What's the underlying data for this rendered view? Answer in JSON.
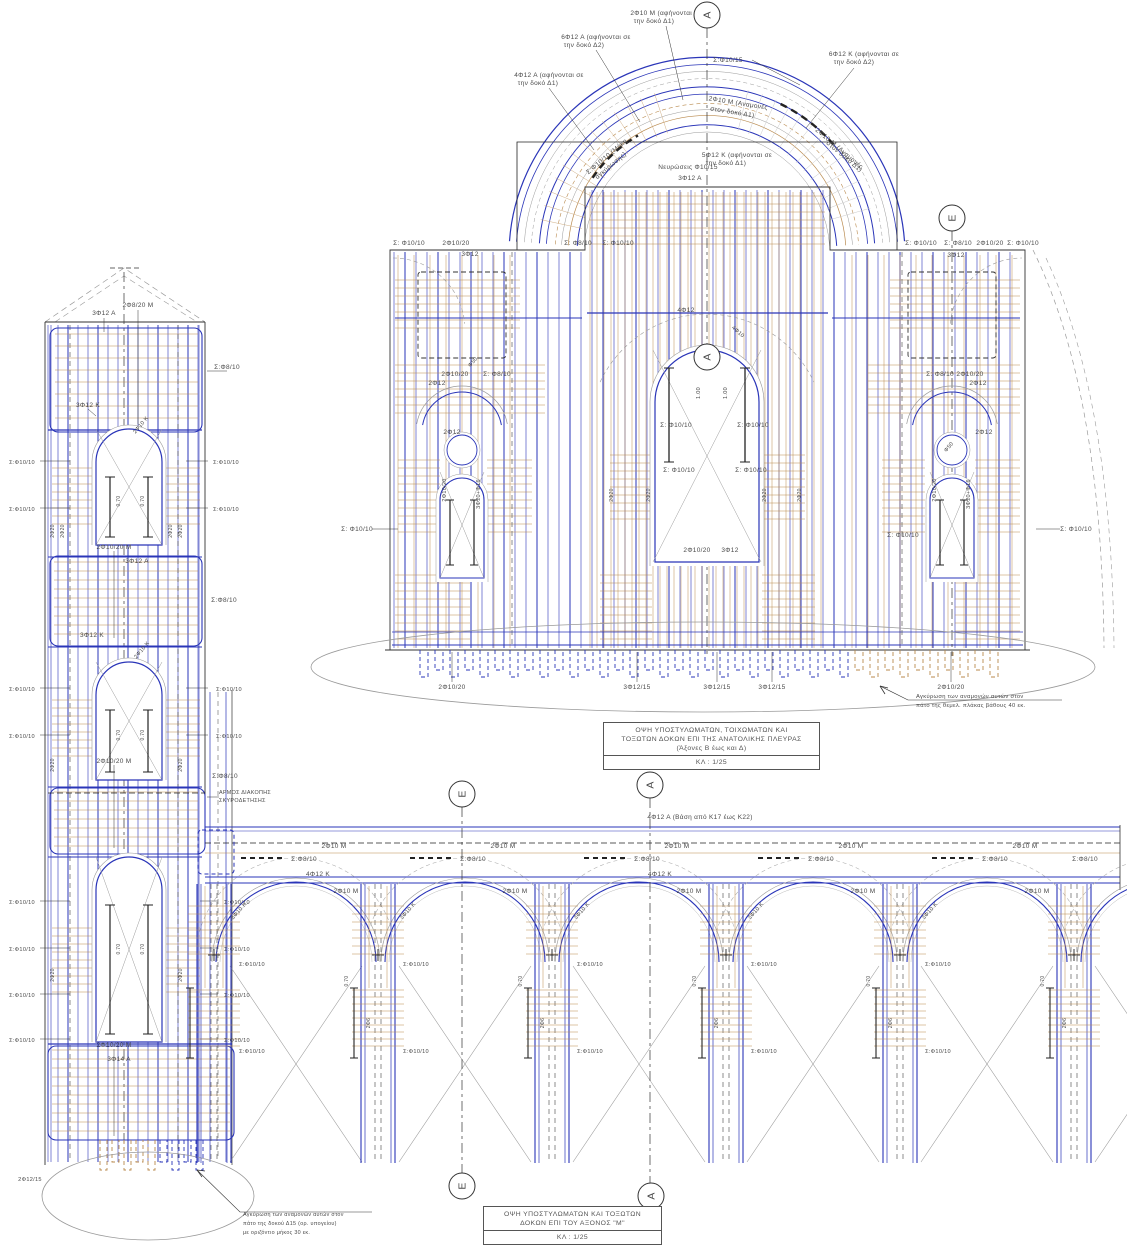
{
  "palette": {
    "blue": "#2a35b8",
    "navy": "#1a1a8c",
    "tan": "#b98a4e",
    "tan_light": "#cfae84",
    "gray": "#9a9a9a",
    "ink": "#4a4a4a",
    "ink_light": "#8d8d8d",
    "black": "#222222"
  },
  "east_elevation": {
    "title": {
      "lines": [
        "ΟΨΗ ΥΠΟΣΤΥΛΩΜΑΤΩΝ, ΤΟΙΧΩΜΑΤΩΝ ΚΑΙ",
        "ΤΟΞΩΤΩΝ ΔΟΚΩΝ ΕΠΙ ΤΗΣ ΑΝΑΤΟΛΙΚΗΣ ΠΛΕΥΡΑΣ",
        "(Άξονες Β έως και Δ)"
      ],
      "scale": "ΚΛ : 1/25"
    },
    "axes": [
      {
        "label": "Α",
        "x": 707,
        "y": 15
      },
      {
        "label": "Ε",
        "x": 952,
        "y": 218
      },
      {
        "label": "Α",
        "x": 707,
        "y": 357
      }
    ],
    "note": {
      "lines": [
        "Αγκύρωση των αναμονών αυτών στον",
        "πάτο της θεμελ. πλάκας βάθους 40 εκ."
      ]
    },
    "labels": [
      {
        "t": "6Φ12 Α (αφήνονται σε",
        "x": 596,
        "y": 39
      },
      {
        "t": "την δοκό Δ2)",
        "x": 584,
        "y": 47
      },
      {
        "t": "2Φ10 Μ (αφήνονται σε",
        "x": 666,
        "y": 15
      },
      {
        "t": "την δοκό Δ1)",
        "x": 654,
        "y": 23
      },
      {
        "t": "6Φ12 Κ (αφήνονται σε",
        "x": 864,
        "y": 56
      },
      {
        "t": "την δοκό Δ2)",
        "x": 854,
        "y": 64
      },
      {
        "t": "4Φ12 Α (αφήνονται σε",
        "x": 549,
        "y": 77
      },
      {
        "t": "την δοκό Δ1)",
        "x": 538,
        "y": 85
      },
      {
        "t": "Σ:Φ10/15",
        "x": 728,
        "y": 62
      },
      {
        "t": "2Φ10 Μ (Αναμονές",
        "x": 738,
        "y": 105,
        "r": 9
      },
      {
        "t": "στον δοκό Δ1)",
        "x": 732,
        "y": 114,
        "r": 9
      },
      {
        "t": "Σ:Φ10/10 (Μήκη",
        "x": 608,
        "y": 158,
        "r": -40
      },
      {
        "t": "αγκύρωσης)",
        "x": 612,
        "y": 167,
        "r": -40
      },
      {
        "t": "2Φ10 Μ (Αναμονές",
        "x": 838,
        "y": 150,
        "r": 40
      },
      {
        "t": "στον δοκό Δ1)",
        "x": 843,
        "y": 158,
        "r": 40
      },
      {
        "t": "Νευρώσεις Φ10/15",
        "x": 688,
        "y": 169
      },
      {
        "t": "3Φ12 Α",
        "x": 690,
        "y": 180
      },
      {
        "t": "5Φ12 Κ (αφήνονται σε",
        "x": 737,
        "y": 157
      },
      {
        "t": "την δοκό Δ1)",
        "x": 726,
        "y": 165
      },
      {
        "t": "Σ: Φ10/10",
        "x": 409,
        "y": 245
      },
      {
        "t": "2Φ10/20",
        "x": 456,
        "y": 245
      },
      {
        "t": "3Φ12",
        "x": 470,
        "y": 256
      },
      {
        "t": "Σ: Φ8/10",
        "x": 578,
        "y": 245
      },
      {
        "t": "Σ: Φ10/10",
        "x": 618,
        "y": 245
      },
      {
        "t": "Σ: Φ10/10",
        "x": 921,
        "y": 245
      },
      {
        "t": "Σ: Φ8/10",
        "x": 958,
        "y": 245
      },
      {
        "t": "2Φ10/20",
        "x": 990,
        "y": 245
      },
      {
        "t": "Σ: Φ10/10",
        "x": 1023,
        "y": 245
      },
      {
        "t": "3Φ12",
        "x": 956,
        "y": 257
      },
      {
        "t": "Σ: Φ10/10",
        "x": 357,
        "y": 531
      },
      {
        "t": "Σ: Φ10/10",
        "x": 1076,
        "y": 531
      },
      {
        "t": "2Φ10/20",
        "x": 455,
        "y": 376
      },
      {
        "t": "Σ: Φ8/10",
        "x": 497,
        "y": 376
      },
      {
        "t": "2Φ12",
        "x": 437,
        "y": 385
      },
      {
        "t": "Φ50",
        "x": 474,
        "y": 363,
        "r": -50,
        "s": 5.5
      },
      {
        "t": "2Φ12",
        "x": 452,
        "y": 434
      },
      {
        "t": "2Φ10/20",
        "x": 446,
        "y": 490,
        "r": -90,
        "s": 5.5
      },
      {
        "t": "3Φ20+Φ16",
        "x": 480,
        "y": 494,
        "r": -90,
        "s": 5.5
      },
      {
        "t": "Σ: Φ8/10",
        "x": 940,
        "y": 376
      },
      {
        "t": "2Φ10/20",
        "x": 970,
        "y": 376
      },
      {
        "t": "2Φ12",
        "x": 978,
        "y": 385
      },
      {
        "t": "2Φ12",
        "x": 984,
        "y": 434
      },
      {
        "t": "Φ50",
        "x": 950,
        "y": 448,
        "r": -50,
        "s": 5.5
      },
      {
        "t": "2Φ10/20",
        "x": 936,
        "y": 490,
        "r": -90,
        "s": 5.5
      },
      {
        "t": "3Φ20+Φ16",
        "x": 970,
        "y": 494,
        "r": -90,
        "s": 5.5
      },
      {
        "t": "Σ: Φ10/10",
        "x": 903,
        "y": 537
      },
      {
        "t": "4Φ12",
        "x": 686,
        "y": 312
      },
      {
        "t": "4Φ10",
        "x": 737,
        "y": 333,
        "r": 42,
        "s": 5.5
      },
      {
        "t": "Σ: Φ10/10",
        "x": 676,
        "y": 427
      },
      {
        "t": "Σ: Φ10/10",
        "x": 753,
        "y": 427
      },
      {
        "t": "Σ: Φ10/10",
        "x": 679,
        "y": 472
      },
      {
        "t": "Σ: Φ10/10",
        "x": 751,
        "y": 472
      },
      {
        "t": "1.00",
        "x": 700,
        "y": 393,
        "r": -90,
        "s": 5.5,
        "c": "g"
      },
      {
        "t": "1.00",
        "x": 727,
        "y": 393,
        "r": -90,
        "s": 5.5,
        "c": "g"
      },
      {
        "t": "2Φ20",
        "x": 613,
        "y": 495,
        "r": -90,
        "s": 5,
        "c": "g"
      },
      {
        "t": "2Φ20",
        "x": 650,
        "y": 495,
        "r": -90,
        "s": 5,
        "c": "g"
      },
      {
        "t": "2Φ20",
        "x": 766,
        "y": 495,
        "r": -90,
        "s": 5,
        "c": "g"
      },
      {
        "t": "2Φ20",
        "x": 801,
        "y": 495,
        "r": -90,
        "s": 5,
        "c": "g"
      },
      {
        "t": "2Φ10/20",
        "x": 697,
        "y": 552
      },
      {
        "t": "3Φ12",
        "x": 730,
        "y": 552
      },
      {
        "t": "2Φ10/20",
        "x": 452,
        "y": 689
      },
      {
        "t": "3Φ12/15",
        "x": 637,
        "y": 689
      },
      {
        "t": "3Φ12/15",
        "x": 717,
        "y": 689
      },
      {
        "t": "3Φ12/15",
        "x": 772,
        "y": 689
      },
      {
        "t": "2Φ10/20",
        "x": 951,
        "y": 689
      },
      {
        "t": "Αγκύρωση των αναμονών αυτών στον",
        "x": 916,
        "y": 698,
        "a": "s",
        "s": 5.8
      },
      {
        "t": "πάτο της θεμελ. πλάκας βάθους 40 εκ.",
        "x": 916,
        "y": 707,
        "a": "s",
        "s": 5.8
      }
    ]
  },
  "tower": {
    "note": {
      "lines": [
        "Αγκύρωση των αναμονών αυτών στον",
        "πάτο της δοκού Δ15 (ορ. υπογείου)",
        "με οριζόντιο μήκος 30 εκ."
      ]
    },
    "labels": [
      {
        "t": "3Φ12 Α",
        "x": 104,
        "y": 315
      },
      {
        "t": "2Φ8/20 Μ",
        "x": 138,
        "y": 307
      },
      {
        "t": "Σ:Φ8/10",
        "x": 227,
        "y": 369
      },
      {
        "t": "3Φ12 Κ",
        "x": 88,
        "y": 407
      },
      {
        "t": "2Φ10 Κ",
        "x": 142,
        "y": 426,
        "r": -50,
        "s": 5.5
      },
      {
        "t": "Σ:Φ10/10",
        "x": 22,
        "y": 464,
        "s": 5.6
      },
      {
        "t": "Σ:Φ10/10",
        "x": 22,
        "y": 511,
        "s": 5.6
      },
      {
        "t": "Σ:Φ10/10",
        "x": 226,
        "y": 464,
        "s": 5.6
      },
      {
        "t": "Σ:Φ10/10",
        "x": 226,
        "y": 511,
        "s": 5.6
      },
      {
        "t": "2Φ10/20 Μ",
        "x": 114,
        "y": 549
      },
      {
        "t": "3Φ12 Α",
        "x": 137,
        "y": 563
      },
      {
        "t": "Σ:Φ8/10",
        "x": 224,
        "y": 602
      },
      {
        "t": "3Φ12 Κ",
        "x": 92,
        "y": 637
      },
      {
        "t": "2Φ10 Κ",
        "x": 143,
        "y": 651,
        "r": -50,
        "s": 5.5
      },
      {
        "t": "Σ:Φ10/10",
        "x": 22,
        "y": 691,
        "s": 5.6
      },
      {
        "t": "Σ:Φ10/10",
        "x": 22,
        "y": 738,
        "s": 5.6
      },
      {
        "t": "Σ:Φ10/10",
        "x": 229,
        "y": 691,
        "s": 5.6
      },
      {
        "t": "Σ:Φ10/10",
        "x": 229,
        "y": 738,
        "s": 5.6
      },
      {
        "t": "2Φ10/20 Μ",
        "x": 114,
        "y": 763
      },
      {
        "t": "Σ:Φ8/10",
        "x": 225,
        "y": 778
      },
      {
        "t": "ΑΡΜΟΣ ΔΙΑΚΟΠΗΣ",
        "x": 219,
        "y": 794,
        "a": "s",
        "s": 5.4
      },
      {
        "t": "ΣΚΥΡΟΔΕΤΗΣΗΣ",
        "x": 219,
        "y": 802,
        "a": "s",
        "s": 5.4
      },
      {
        "t": "Σ:Φ10/10",
        "x": 22,
        "y": 904,
        "s": 5.6
      },
      {
        "t": "Σ:Φ10/10",
        "x": 22,
        "y": 951,
        "s": 5.6
      },
      {
        "t": "Σ:Φ10/10",
        "x": 237,
        "y": 904,
        "s": 5.6
      },
      {
        "t": "Σ:Φ10/10",
        "x": 237,
        "y": 951,
        "s": 5.6
      },
      {
        "t": "Σ:Φ10/10",
        "x": 22,
        "y": 997,
        "s": 5.6
      },
      {
        "t": "Σ:Φ10/10",
        "x": 22,
        "y": 1042,
        "s": 5.6
      },
      {
        "t": "Σ:Φ10/10",
        "x": 237,
        "y": 997,
        "s": 5.6
      },
      {
        "t": "Σ:Φ10/10",
        "x": 237,
        "y": 1042,
        "s": 5.6
      },
      {
        "t": "2Φ10/20 Μ",
        "x": 114,
        "y": 1047
      },
      {
        "t": "3Φ14 Α",
        "x": 119,
        "y": 1061
      },
      {
        "t": "2Φ20",
        "x": 54,
        "y": 531,
        "r": -90,
        "s": 5,
        "c": "g"
      },
      {
        "t": "2Φ20",
        "x": 64,
        "y": 531,
        "r": -90,
        "s": 5,
        "c": "g"
      },
      {
        "t": "2Φ20",
        "x": 172,
        "y": 531,
        "r": -90,
        "s": 5,
        "c": "g"
      },
      {
        "t": "2Φ20",
        "x": 182,
        "y": 531,
        "r": -90,
        "s": 5,
        "c": "g"
      },
      {
        "t": "2Φ20",
        "x": 54,
        "y": 765,
        "r": -90,
        "s": 5,
        "c": "g"
      },
      {
        "t": "2Φ20",
        "x": 182,
        "y": 765,
        "r": -90,
        "s": 5,
        "c": "g"
      },
      {
        "t": "2Φ20",
        "x": 54,
        "y": 975,
        "r": -90,
        "s": 5,
        "c": "g"
      },
      {
        "t": "2Φ20",
        "x": 182,
        "y": 975,
        "r": -90,
        "s": 5,
        "c": "g"
      },
      {
        "t": "0.70",
        "x": 120,
        "y": 501,
        "r": -90,
        "s": 5,
        "c": "g"
      },
      {
        "t": "0.70",
        "x": 144,
        "y": 501,
        "r": -90,
        "s": 5,
        "c": "g"
      },
      {
        "t": "0.70",
        "x": 120,
        "y": 735,
        "r": -90,
        "s": 5,
        "c": "g"
      },
      {
        "t": "0.70",
        "x": 144,
        "y": 735,
        "r": -90,
        "s": 5,
        "c": "g"
      },
      {
        "t": "0.70",
        "x": 120,
        "y": 949,
        "r": -90,
        "s": 5,
        "c": "g"
      },
      {
        "t": "0.70",
        "x": 144,
        "y": 949,
        "r": -90,
        "s": 5,
        "c": "g"
      },
      {
        "t": "2Φ12/15",
        "x": 30,
        "y": 1181,
        "s": 5.6
      },
      {
        "t": "Αγκύρωση των αναμονών αυτών στον",
        "x": 243,
        "y": 1216,
        "a": "s",
        "s": 5.4
      },
      {
        "t": "πάτο της δοκού Δ15 (ορ. υπογείου)",
        "x": 243,
        "y": 1225,
        "a": "s",
        "s": 5.4
      },
      {
        "t": "με οριζόντιο μήκος 30 εκ.",
        "x": 243,
        "y": 1234,
        "a": "s",
        "s": 5.4
      }
    ]
  },
  "arcade": {
    "title": {
      "lines": [
        "ΟΨΗ ΥΠΟΣΤΥΛΩΜΑΤΩΝ ΚΑΙ ΤΟΞΩΤΩΝ",
        "ΔΟΚΩΝ ΕΠΙ ΤΟΥ ΑΞΟΝΟΣ \"Μ\""
      ],
      "scale": "ΚΛ : 1/25"
    },
    "axes": [
      {
        "label": "Ε",
        "x": 462,
        "y": 794
      },
      {
        "label": "Α",
        "x": 650,
        "y": 785
      },
      {
        "label": "Ε",
        "x": 462,
        "y": 1186
      },
      {
        "label": "Α",
        "x": 651,
        "y": 1196
      }
    ],
    "labels": [
      {
        "t": "4Φ12 Α (Βάση από Κ17 έως Κ22)",
        "x": 700,
        "y": 819
      },
      {
        "t": "Σ:Φ8/10",
        "x": 304,
        "y": 861
      },
      {
        "t": "Σ:Φ8/10",
        "x": 473,
        "y": 861
      },
      {
        "t": "Σ:Φ8/10",
        "x": 647,
        "y": 861
      },
      {
        "t": "Σ:Φ8/10",
        "x": 821,
        "y": 861
      },
      {
        "t": "Σ:Φ8/10",
        "x": 995,
        "y": 861
      },
      {
        "t": "Σ:Φ8/10",
        "x": 1085,
        "y": 861
      },
      {
        "t": "2Φ10 Μ",
        "x": 334,
        "y": 848
      },
      {
        "t": "2Φ10 Μ",
        "x": 503,
        "y": 848
      },
      {
        "t": "2Φ10 Μ",
        "x": 677,
        "y": 848
      },
      {
        "t": "2Φ10 Μ",
        "x": 851,
        "y": 848
      },
      {
        "t": "2Φ10 Μ",
        "x": 1025,
        "y": 848
      },
      {
        "t": "2Φ10 Μ",
        "x": 346,
        "y": 893
      },
      {
        "t": "2Φ10 Μ",
        "x": 515,
        "y": 893
      },
      {
        "t": "2Φ10 Μ",
        "x": 689,
        "y": 893
      },
      {
        "t": "2Φ10 Μ",
        "x": 863,
        "y": 893
      },
      {
        "t": "2Φ10 Μ",
        "x": 1037,
        "y": 893
      },
      {
        "t": "3Φ10 Κ",
        "x": 240,
        "y": 912,
        "r": -48,
        "s": 5.5
      },
      {
        "t": "3Φ10 Κ",
        "x": 409,
        "y": 912,
        "r": -48,
        "s": 5.5
      },
      {
        "t": "3Φ10 Κ",
        "x": 583,
        "y": 912,
        "r": -48,
        "s": 5.5
      },
      {
        "t": "3Φ10 Κ",
        "x": 757,
        "y": 912,
        "r": -48,
        "s": 5.5
      },
      {
        "t": "3Φ10 Κ",
        "x": 931,
        "y": 912,
        "r": -48,
        "s": 5.5
      },
      {
        "t": "4Φ12 Κ",
        "x": 318,
        "y": 876
      },
      {
        "t": "4Φ12 Κ",
        "x": 660,
        "y": 876
      },
      {
        "t": "Σ:Φ10/10",
        "x": 252,
        "y": 966,
        "s": 5.6
      },
      {
        "t": "Σ:Φ10/10",
        "x": 416,
        "y": 966,
        "s": 5.6
      },
      {
        "t": "Σ:Φ10/10",
        "x": 590,
        "y": 966,
        "s": 5.6
      },
      {
        "t": "Σ:Φ10/10",
        "x": 764,
        "y": 966,
        "s": 5.6
      },
      {
        "t": "Σ:Φ10/10",
        "x": 938,
        "y": 966,
        "s": 5.6
      },
      {
        "t": "Σ:Φ10/10",
        "x": 252,
        "y": 1053,
        "s": 5.6
      },
      {
        "t": "Σ:Φ10/10",
        "x": 416,
        "y": 1053,
        "s": 5.6
      },
      {
        "t": "Σ:Φ10/10",
        "x": 590,
        "y": 1053,
        "s": 5.6
      },
      {
        "t": "Σ:Φ10/10",
        "x": 764,
        "y": 1053,
        "s": 5.6
      },
      {
        "t": "Σ:Φ10/10",
        "x": 938,
        "y": 1053,
        "s": 5.6
      },
      {
        "t": "2Φ6",
        "x": 370,
        "y": 1023,
        "r": -90,
        "s": 5,
        "c": "g"
      },
      {
        "t": "2Φ6",
        "x": 544,
        "y": 1023,
        "r": -90,
        "s": 5,
        "c": "g"
      },
      {
        "t": "2Φ6",
        "x": 718,
        "y": 1023,
        "r": -90,
        "s": 5,
        "c": "g"
      },
      {
        "t": "2Φ6",
        "x": 892,
        "y": 1023,
        "r": -90,
        "s": 5,
        "c": "g"
      },
      {
        "t": "2Φ6",
        "x": 1066,
        "y": 1023,
        "r": -90,
        "s": 5,
        "c": "g"
      },
      {
        "t": "0.70",
        "x": 348,
        "y": 981,
        "r": -90,
        "s": 5,
        "c": "g"
      },
      {
        "t": "0.70",
        "x": 522,
        "y": 981,
        "r": -90,
        "s": 5,
        "c": "g"
      },
      {
        "t": "0.70",
        "x": 696,
        "y": 981,
        "r": -90,
        "s": 5,
        "c": "g"
      },
      {
        "t": "0.70",
        "x": 870,
        "y": 981,
        "r": -90,
        "s": 5,
        "c": "g"
      },
      {
        "t": "0.70",
        "x": 1044,
        "y": 981,
        "r": -90,
        "s": 5,
        "c": "g"
      }
    ]
  }
}
